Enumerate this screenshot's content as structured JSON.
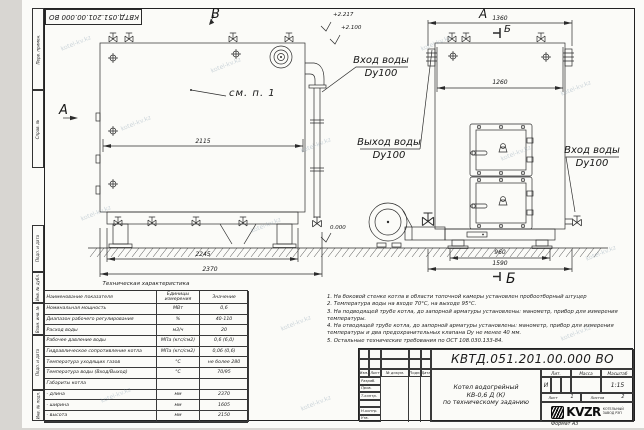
{
  "watermark": "kotel-kv.kz",
  "frame": {
    "designation_top": "КВТД.051.201.00.000 ВО",
    "format": "Формат  А3",
    "side_labels": {
      "top1": "Перв. примен.",
      "top2": "Справ. №",
      "bottom1": "Подп. и дата",
      "bottom2": "Инв. № дубл.",
      "bottom3": "Взам. инв. №",
      "bottom4": "Подп. и дата",
      "bottom5": "Инв. № подл."
    }
  },
  "views": {
    "label_a_side": "А",
    "label_b_top": "В",
    "label_a_front": "А",
    "label_b_mark": "Б",
    "see_note": "см. п. 1"
  },
  "pipes": {
    "inlet_top_line1": "Вход воды",
    "inlet_top_line2": "Dy100",
    "outlet_line1": "Выход воды",
    "outlet_line2": "Dy100",
    "inlet_right_line1": "Вход воды",
    "inlet_right_line2": "Dy100"
  },
  "elevations": {
    "top1": "+2.217",
    "top2": "+2.100",
    "zero": "0.000"
  },
  "dimensions": {
    "side_inner": "2115",
    "side_base": "2245",
    "side_total": "2370",
    "front_total": "1360",
    "front_inner": "1260",
    "front_base": "960",
    "front_base_total": "1590"
  },
  "tech_table": {
    "title": "Техническая характеристика",
    "col_param": "Наименование показателя",
    "col_units": "Единицы измерения",
    "col_value": "Значение",
    "rows": [
      [
        "Номинальная мощность",
        "МВт",
        "0,6"
      ],
      [
        "Диапазон рабочего регулирования",
        "%",
        "40-110"
      ],
      [
        "Расход воды",
        "м3/ч",
        "20"
      ],
      [
        "Рабочее давление воды",
        "МПа (кгс/см2)",
        "0,6 (6,0)"
      ],
      [
        "Гидравлическое сопротивление котла",
        "МПа (кгс/см2)",
        "0,06 (0,6)"
      ],
      [
        "Температура уходящих газов",
        "°С",
        "не более 280"
      ],
      [
        "Температура воды (Вход/Выход)",
        "°С",
        "70/95"
      ],
      [
        "Габариты котла",
        "",
        ""
      ],
      [
        "  - длина",
        "мм",
        "2370"
      ],
      [
        "  - ширина",
        "мм",
        "1605"
      ],
      [
        "  - высота",
        "мм",
        "2150"
      ]
    ]
  },
  "notes": [
    "1. На боковой стенке котла в области топочной камеры установлен пробоотборный штуцер",
    "2. Температура воды на входе 70°С, на выходе 95°С.",
    "3. На подводящей трубе котла, до запорной арматуры установлены: манометр, прибор для измерения температуры.",
    "4. На отводящей трубе котла, до запорной арматуры установлены: манометр, прибор для измерения температуры и два предохранительных клапана Dу не менее 40 мм.",
    "5. Остальные технические требования по ОСТ 108.030.133-84."
  ],
  "title_block": {
    "designation": "КВТД.051.201.00.000  ВО",
    "name_line1": "Котел водогрейный",
    "name_line2": "КВ-0,6 Д (К)",
    "name_line3": "по техническому заданию",
    "col_izm": "Изм.",
    "col_list": "Лист",
    "col_doc": "№ докум.",
    "col_podp": "Подп.",
    "col_data": "Дата",
    "row_razrab": "Разраб.",
    "row_prov": "Пров.",
    "row_tkontr": "Т.контр.",
    "row_nkontr": "Н.контр.",
    "row_utv": "Утв.",
    "lit_label": "Лит.",
    "lit_value": "И",
    "mass_label": "Масса",
    "scale_label": "Масштаб",
    "scale_value": "1:15",
    "sheet_label": "Лист",
    "sheet_value": "1",
    "sheets_label": "Листов",
    "sheets_value": "2",
    "company_logo": "KVZR",
    "company_line1": "КОТЕЛЬНЫЙ",
    "company_line2": "ЗАВОД РЭП"
  }
}
